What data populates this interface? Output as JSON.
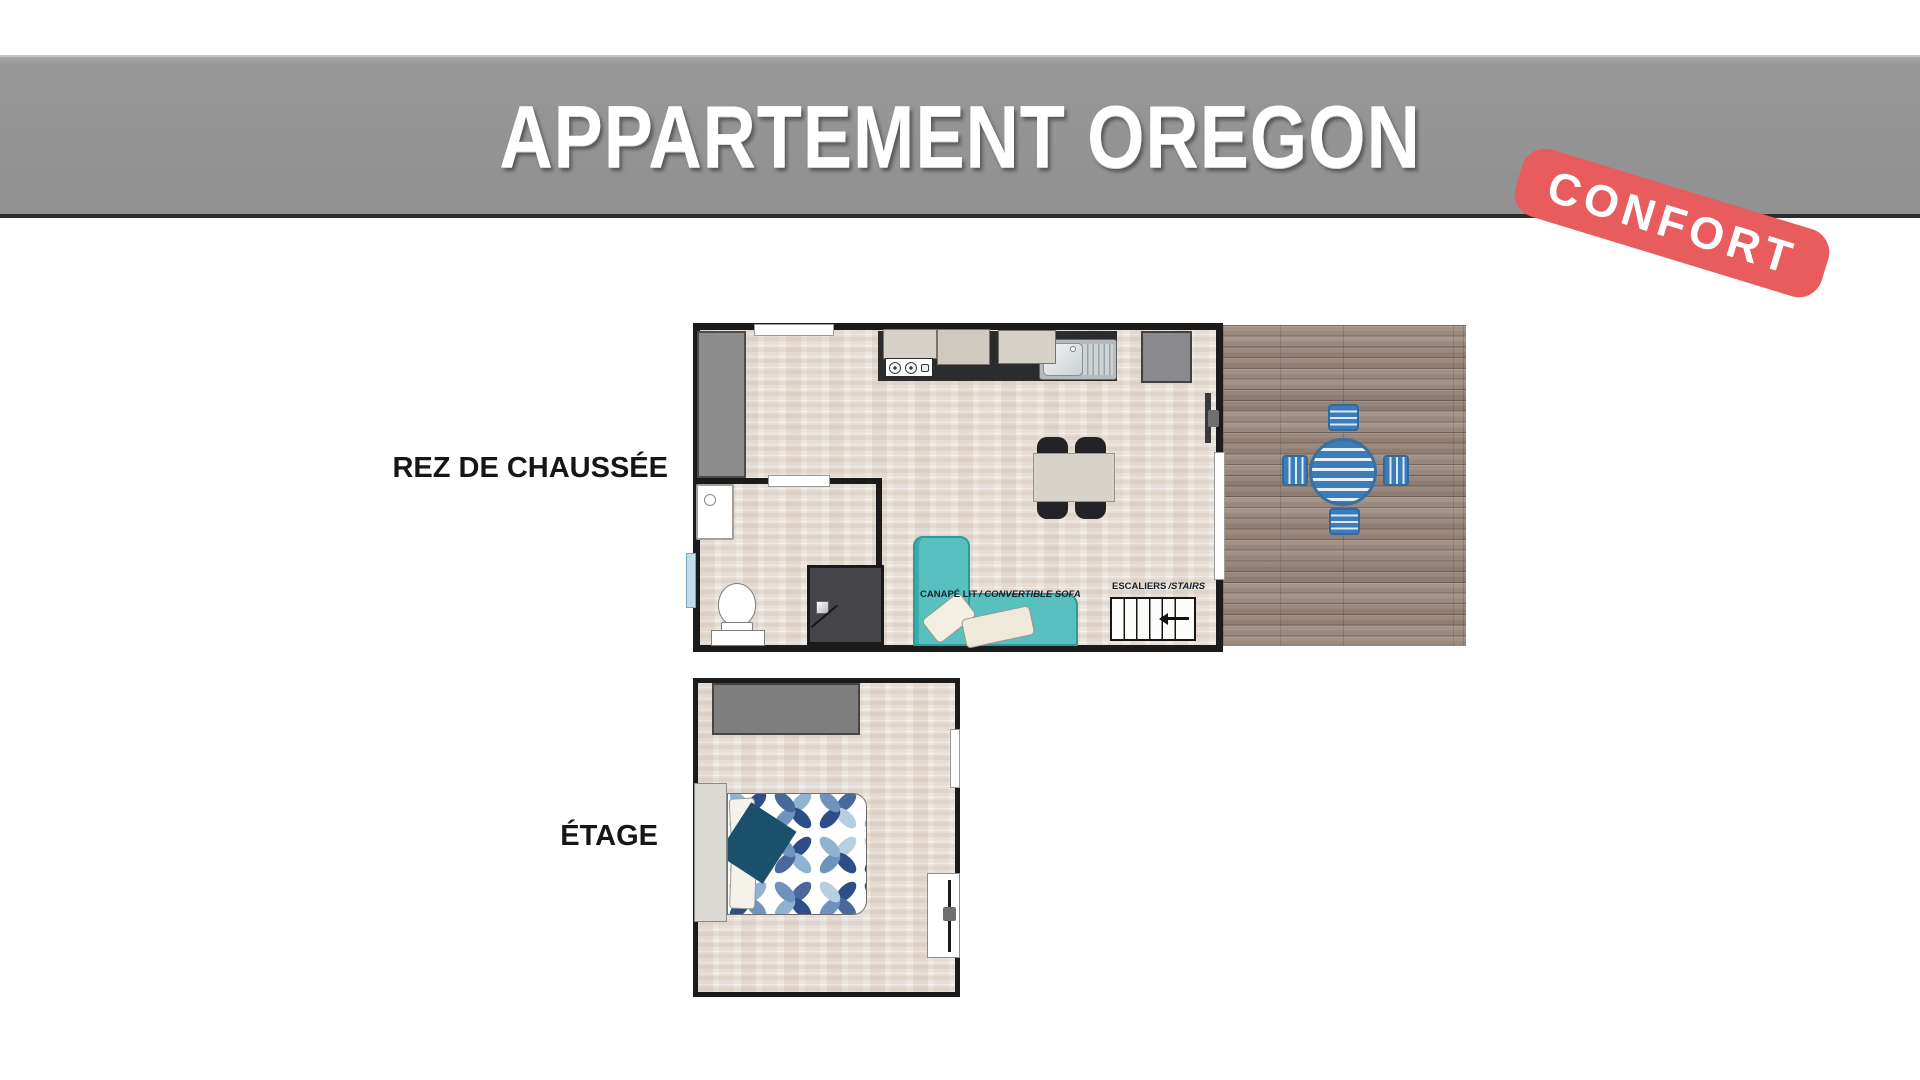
{
  "header": {
    "title": "APPARTEMENT OREGON",
    "badge": "CONFORT",
    "badge_color": "#e85c5e",
    "banner_color": "#949494"
  },
  "floors": {
    "ground": {
      "label": "REZ DE CHAUSSÉE",
      "annotations": {
        "sofa": {
          "fr": "CANAPÉ LIT",
          "en": "/ CONVERTIBLE SOFA"
        },
        "stairs": {
          "fr": "ESCALIERS",
          "en": "/STAIRS"
        }
      }
    },
    "upper": {
      "label": "ÉTAGE"
    }
  },
  "colors": {
    "sofa_teal": "#58c1c0",
    "terrace_furniture_blue": "#3c7cb8",
    "wood_deck": "#9f8d83",
    "floor_beige": "#ebe5df",
    "wall_black": "#1b1b1b",
    "wardrobe_gray": "#8d8d8d",
    "bed_throw_navy": "#1a506b",
    "bed_pattern_blues": [
      "#2d4e86",
      "#49699c",
      "#6e93bd",
      "#8fb3d1",
      "#b6cfe0"
    ]
  }
}
